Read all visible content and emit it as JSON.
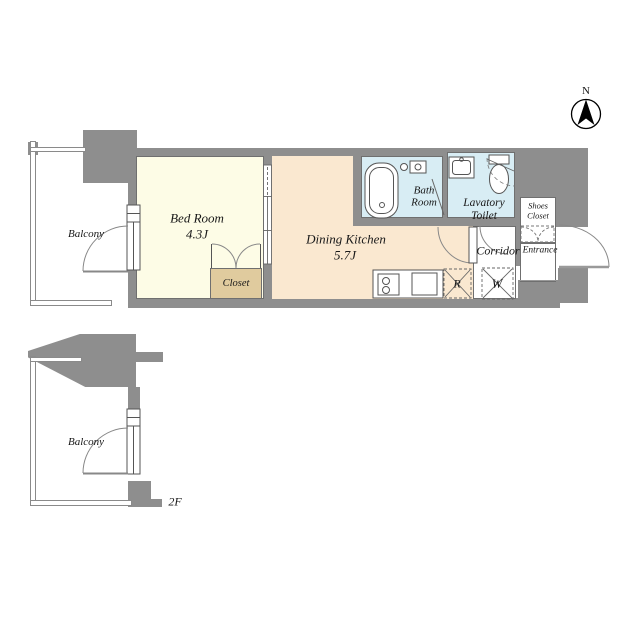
{
  "compass": {
    "label": "N"
  },
  "rooms": {
    "balcony": {
      "label": "Balcony"
    },
    "bedroom": {
      "label": "Bed Room",
      "size": "4.3J"
    },
    "dining_kitchen": {
      "label": "Dining Kitchen",
      "size": "5.7J"
    },
    "closet": {
      "label": "Closet"
    },
    "bathroom": {
      "line1": "Bath",
      "line2": "Room"
    },
    "lavatory": {
      "line1": "Lavatory",
      "line2": "Toilet"
    },
    "corridor": {
      "label": "Corridor"
    },
    "shoes_closet": {
      "line1": "Shoes",
      "line2": "Closet"
    },
    "entrance": {
      "label": "Entrance"
    },
    "refrigerator": {
      "label": "R"
    },
    "washer": {
      "label": "W"
    },
    "balcony_2f": {
      "label": "Balcony"
    }
  },
  "floor_tag": {
    "label": "2F"
  },
  "colors": {
    "wall": "#8e8e8e",
    "bedroom_fill": "#fdfce6",
    "dining_kitchen_fill": "#fae8d0",
    "wet_area_fill": "#d8edf4",
    "closet_fill": "#e0cb9e",
    "outline": "#555555"
  }
}
